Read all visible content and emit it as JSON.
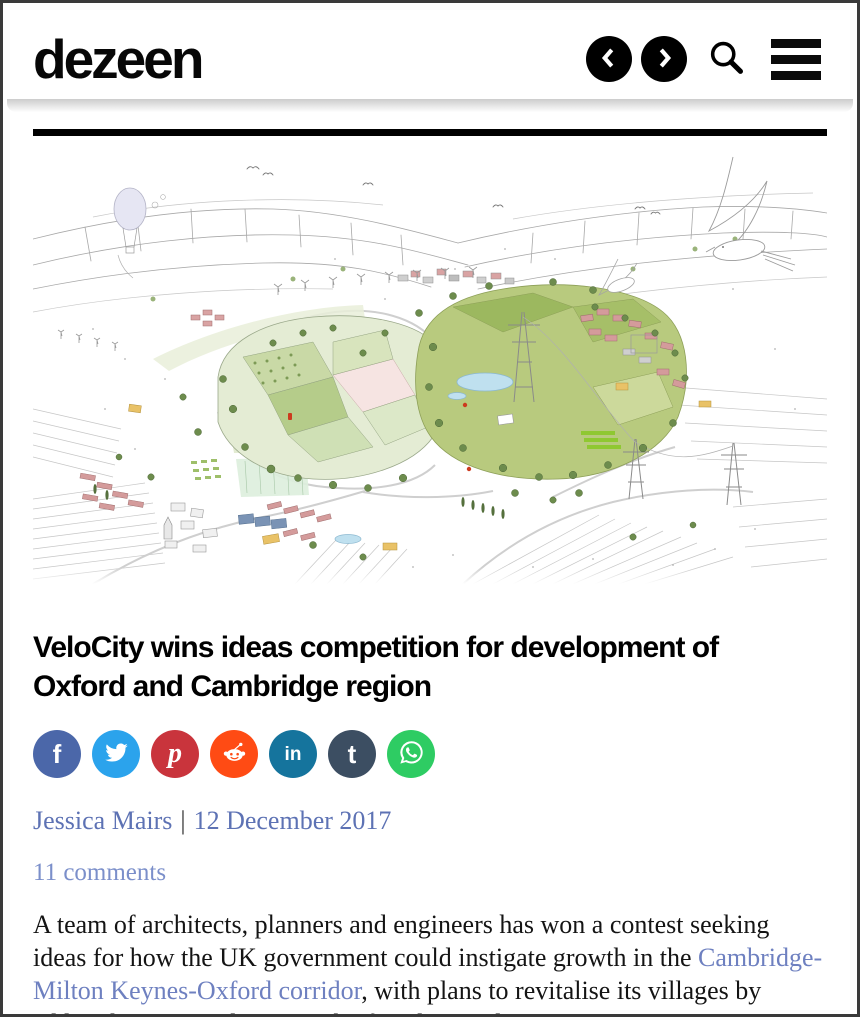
{
  "header": {
    "logo_text": "dezeen",
    "icons": [
      "prev-circle-icon",
      "next-circle-icon",
      "search-icon",
      "hamburger-menu-icon"
    ]
  },
  "article": {
    "headline": "VeloCity wins ideas competition for development of Oxford and Cambridge region",
    "author": "Jessica Mairs",
    "byline_separator": "|",
    "date": "12 December 2017",
    "comments_link": "11 comments",
    "body": {
      "before_link": "A team of architects, planners and engineers has won a contest seeking ideas for how the UK government could instigate growth in the ",
      "link_text": "Cambridge-Milton Keynes-Oxford corridor",
      "after_link": ", with plans to revitalise its villages by adding housing and a network of cycling and"
    }
  },
  "social": {
    "items": [
      {
        "name": "facebook",
        "glyph": "f",
        "color": "#4b67a9"
      },
      {
        "name": "twitter",
        "glyph": "twitter-bird",
        "color": "#2ba3ec"
      },
      {
        "name": "pinterest",
        "glyph": "p",
        "color": "#c9343c"
      },
      {
        "name": "reddit",
        "glyph": "reddit-alien",
        "color": "#ff4b14"
      },
      {
        "name": "linkedin",
        "glyph": "in",
        "color": "#15749d"
      },
      {
        "name": "tumblr",
        "glyph": "t",
        "color": "#3c4e62"
      },
      {
        "name": "whatsapp",
        "glyph": "whatsapp-phone",
        "color": "#2ecc63"
      }
    ]
  },
  "colors": {
    "headline": "#000000",
    "body_text": "#141414",
    "byline_link": "#5d72b4",
    "comments_link": "#7b8fca",
    "inline_link": "#6e80c0",
    "rule": "#000000",
    "illustration_palette": [
      "#e4ecd4",
      "#b8ca7e",
      "#9cb85f",
      "#f6e4e2",
      "#d49b9b",
      "#bfe0ef",
      "#e9c267",
      "#7a93b5",
      "#6d8c4d"
    ]
  }
}
